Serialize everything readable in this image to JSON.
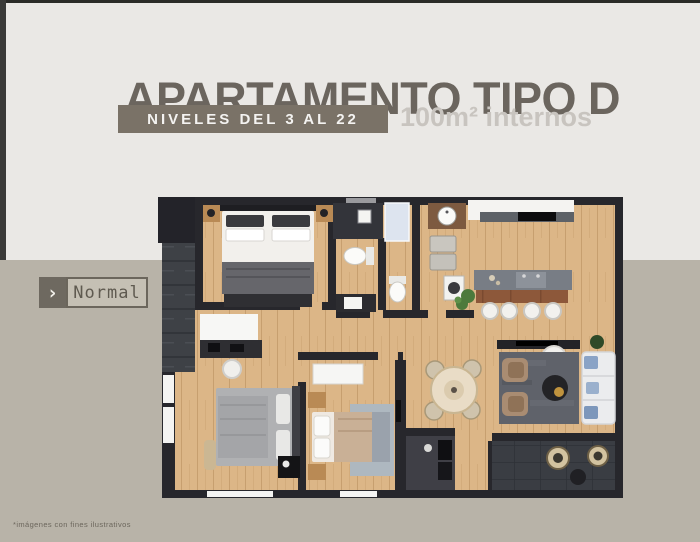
{
  "header": {
    "title": "APARTAMENTO TIPO D",
    "levels_badge": "NIVELES DEL 3 AL 22",
    "area_text": "100m² internos"
  },
  "view_toggle": {
    "chevron": "›",
    "label": "Normal"
  },
  "footer": {
    "disclaimer": "*imágenes con fines ilustrativos"
  },
  "colors": {
    "page_bg": "#eae8e5",
    "band_bg": "#b8b3a8",
    "title": "#6b655e",
    "badge_bg": "#7a7267",
    "badge_text": "#f4f3f1",
    "area_text": "#c8c4bf",
    "wall": "#27272c",
    "wood_floor": "#dcb687",
    "balcony_floor": "#3a3d43"
  }
}
